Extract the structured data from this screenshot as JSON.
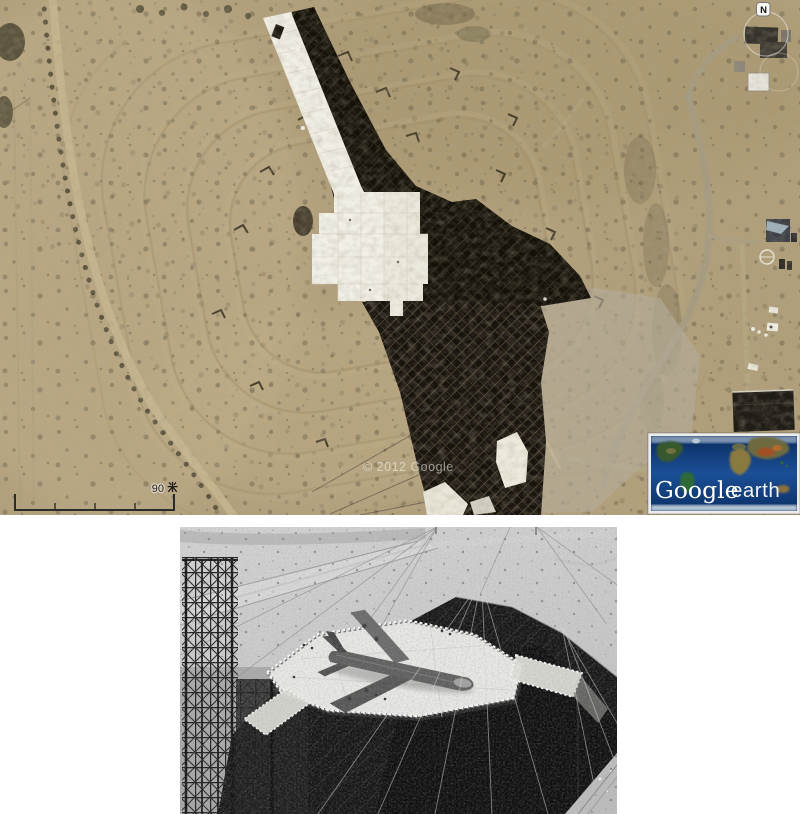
{
  "window": {
    "width_px": 800,
    "height_px": 814,
    "background": "#ffffff"
  },
  "satellite_view": {
    "kind": "google-earth-aerial-imagery",
    "subject": "large white trestle test platform with ramp in desert terrain",
    "compass": {
      "label": "N"
    },
    "copyright_watermark": "© 2012 Google",
    "scale_bar": {
      "label": "90 米",
      "value": "90",
      "unit": "米",
      "segments": 4
    },
    "logo_overlay": {
      "brand_word_1": "Google",
      "brand_word_2": "earth"
    },
    "colors": {
      "desert_tan": "#b2a07c",
      "scrub_olive": "#5d5741",
      "structure_shadow": "#141109",
      "platform_white": "#f0eee5",
      "road_light": "#c7b792",
      "concrete_gray": "#b6ae9c",
      "logo_ocean_blue": "#123a72",
      "logo_border_white": "#ececea"
    }
  },
  "photo": {
    "kind": "black-and-white-aerial-photograph",
    "subject": "swept-wing aircraft parked on wooden trestle platform with guy wires",
    "colors": {
      "terrain_gray": "#cbcbcb",
      "structure_black": "#161616",
      "deck_white": "#e8e8e5",
      "aircraft_gray": "#5f5f5f"
    }
  }
}
